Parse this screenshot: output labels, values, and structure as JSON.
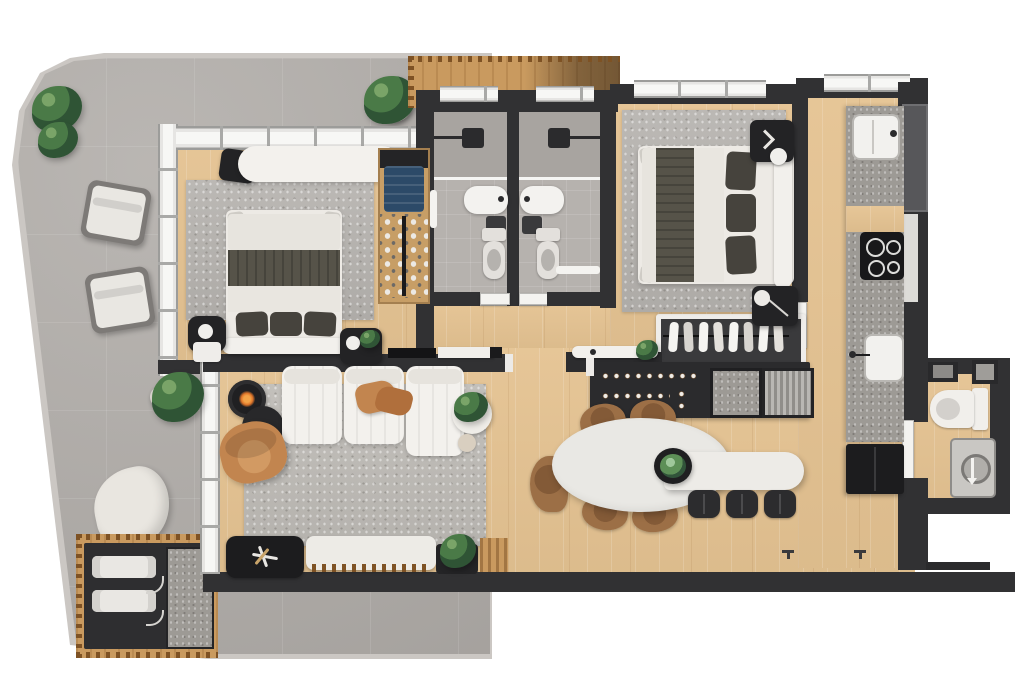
{
  "scene": {
    "type": "apartment-floor-plan-3d-render",
    "view": "top-down",
    "background": "#ffffff",
    "text": ""
  },
  "palette": {
    "bg": "#ffffff",
    "balcony": "#b2aeaa",
    "balcony_edge": "#cbc7c3",
    "tile_bath": "#b6b2ae",
    "wood": "#e5c392",
    "wood_deck": "#c99a5f",
    "wall": "#313133",
    "window_frame": "#e6e5e3",
    "rug": "#b7b4b0",
    "white_furn": "#f3f1ed",
    "duvet": "#e7e4de",
    "throw_dark": "#565349",
    "pillow_dark": "#46433d",
    "leather": "#c2854f",
    "plant_green": "#3f6b45",
    "black_furn": "#232325",
    "stone": "#9d9a95",
    "chair_wood": "#9c6f46",
    "flame": "#e0762a",
    "appliance_gray": "#c9c7c3",
    "blue_clothes": "#2c4a68"
  },
  "rooms": [
    {
      "name": "balcony",
      "floor": "gray-tile"
    },
    {
      "name": "bedroom-1",
      "floor": "wood"
    },
    {
      "name": "bathroom-1",
      "floor": "gray-tile"
    },
    {
      "name": "bathroom-2",
      "floor": "gray-tile"
    },
    {
      "name": "master-bedroom",
      "floor": "wood"
    },
    {
      "name": "kitchen",
      "floor": "wood"
    },
    {
      "name": "living-room",
      "floor": "wood"
    },
    {
      "name": "dining-area",
      "floor": "wood"
    },
    {
      "name": "laundry-bathroom",
      "floor": "wood"
    }
  ],
  "furniture": {
    "balcony": [
      "potted-plant",
      "potted-plant",
      "potted-plant",
      "potted-plant",
      "lounge-chair",
      "lounge-chair",
      "curved-lounge-chair",
      "ac-unit",
      "ac-unit",
      "stone-panel",
      "wood-deck"
    ],
    "bedroom_1": [
      "area-rug",
      "double-bed",
      "desk",
      "desk-chair",
      "nightstand-with-lamp",
      "nightstand-with-plant",
      "wardrobe",
      "clothes-stack",
      "shoe-rack"
    ],
    "bathroom_1": [
      "walk-in-shower",
      "shower-head",
      "vanity-sink",
      "toilet",
      "towel-rail",
      "pocket-door",
      "window"
    ],
    "bathroom_2": [
      "walk-in-shower",
      "shower-head",
      "vanity-sink",
      "toilet",
      "towel-rail",
      "pocket-door",
      "window"
    ],
    "master_bedroom": [
      "area-rug",
      "double-bed",
      "nightstand-with-lamp",
      "nightstand-with-lamp",
      "closet-hanging-rail",
      "window"
    ],
    "kitchen": [
      "countertop",
      "sink",
      "prep-sink",
      "cooktop",
      "refrigerator",
      "tall-cabinet",
      "window"
    ],
    "living_room": [
      "area-rug",
      "modular-sofa",
      "leather-throw",
      "armchair",
      "coffee-table",
      "candle-table",
      "side-table-with-plant",
      "tv-console",
      "shelf",
      "window-bench",
      "bench-tray-table",
      "bench-plant",
      "balcony-sliding-door"
    ],
    "dining_area": [
      "oval-dining-table",
      "wood-chair",
      "wood-chair",
      "wood-chair",
      "wood-chair",
      "wood-chair",
      "bar-counter",
      "bar-stool",
      "bar-stool",
      "bar-stool",
      "planter-bowl",
      "wine-cabinet",
      "stone-cabinet-panel",
      "radiator-unit",
      "display-ledge"
    ],
    "laundry_bathroom": [
      "toilet",
      "washing-machine",
      "wall-shelf",
      "mirror-cabinet",
      "door"
    ]
  }
}
